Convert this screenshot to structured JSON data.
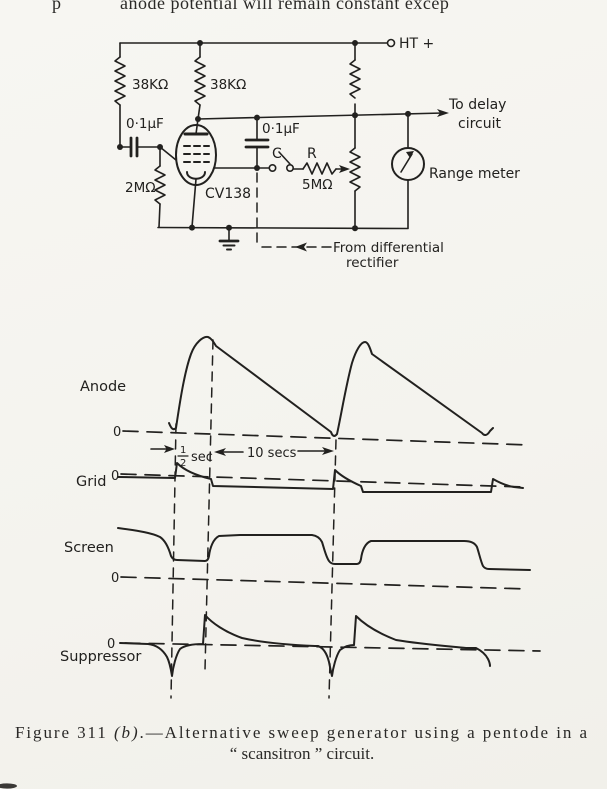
{
  "page": {
    "top_fragment": {
      "left": "p",
      "main": "anode potential will remain constant excep"
    },
    "caption": {
      "prefix": "Figure 311 ",
      "fig_letter": "(b)",
      "rest": ".—Alternative  sweep  generator  using  a  pentode  in  a",
      "line2": "“ scansitron ” circuit."
    },
    "ink_color": "#22211f",
    "paper_color": "#f6f5f0"
  },
  "circuit": {
    "labels": {
      "resistor_left": "38KΩ",
      "resistor_anode": "38KΩ",
      "cap_grid": "0·1μF",
      "cap_coupling": "0·1μF",
      "resistor_grid": "2MΩ",
      "valve": "CV138",
      "switch": "C",
      "series_resistor": "R",
      "series_resistor_value": "5MΩ",
      "supply": "HT +",
      "delay_line1": "To delay",
      "delay_line2": "circuit",
      "meter": "Range meter",
      "from_rect_line1": "From differential",
      "from_rect_line2": "rectifier"
    }
  },
  "waveforms": {
    "anode": {
      "label": "Anode",
      "zero": "0",
      "shape": "rapid exponential rise during half-second flyback, then linear ramp down over ten-second sweep (repeating sawtooth)"
    },
    "grid": {
      "label": "Grid",
      "zero": "0",
      "shape": "held slightly negative during sweep; positive decaying spike at each flyback"
    },
    "screen": {
      "label": "Screen",
      "zero": "0",
      "shape": "high during sweep, drops to low level during flyback (rounded square wave)"
    },
    "suppressor": {
      "label": "Suppressor",
      "zero": "0",
      "shape": "sharp negative decaying spike at flyback start followed by positive decaying spike at sweep start"
    },
    "timing": {
      "frac_num": "1",
      "frac_den": "2",
      "frac_unit": "sec",
      "sweep": "10 secs"
    }
  }
}
